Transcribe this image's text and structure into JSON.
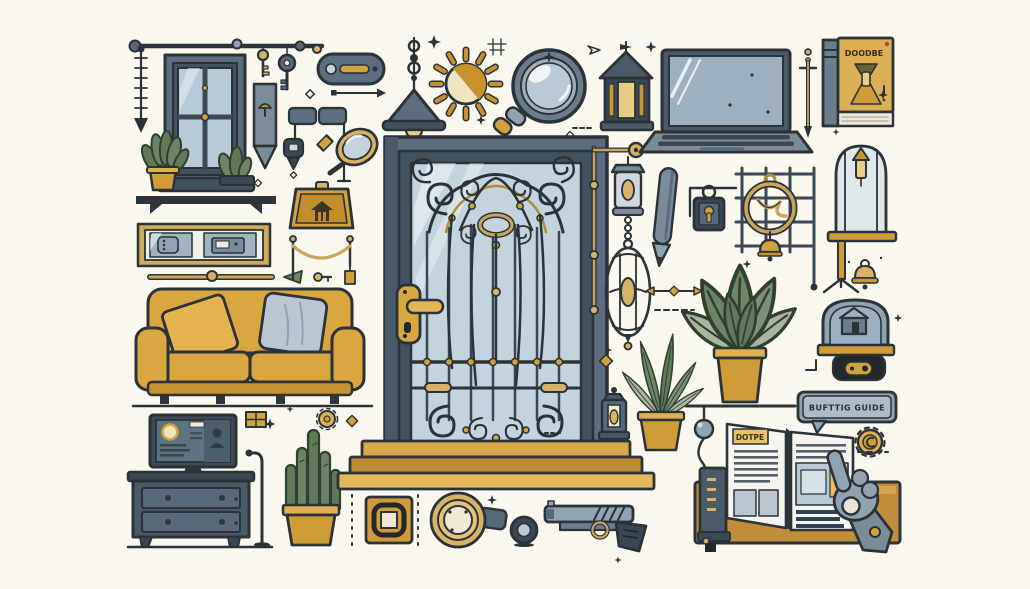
{
  "scene": {
    "description": "flat vector illustration collage of home, door-security and shopping-guide objects on cream background",
    "background": "#FAF8EE",
    "palette": {
      "outline": "#2B3238",
      "slate": "#5B6D7E",
      "slate_dark": "#42525F",
      "slate_light": "#B9CAD6",
      "gold": "#D2A23D",
      "gold_dark": "#A87C26",
      "gold_light": "#E9CD85",
      "green": "#5E7A58",
      "green_back": "#A9B49B",
      "wood": "#C18D3C",
      "paper": "#F5F4EE"
    },
    "texts": {
      "book_cover_title": "DOODBE",
      "guide_page_label": "DOTPE",
      "speech_bubble_label": "BUFTTIG GUIDE"
    },
    "objects": [
      "curtain-rod",
      "measuring-arrow",
      "window",
      "window-plants",
      "wall-shelf",
      "picture-frame",
      "sofa",
      "gold-rod",
      "green-leaf",
      "mini-keys",
      "tv",
      "dresser",
      "floor-lamp",
      "cactus",
      "grid-icon",
      "small-coin",
      "hanging-keys",
      "pennant",
      "key-fob-diagram",
      "hand-mirror",
      "house-plaque",
      "rope-swag",
      "pill-button",
      "arrow-marker",
      "pendant-lamp",
      "sun",
      "magnifying-glass",
      "crosshair-mark",
      "paper-dart",
      "ornate-door",
      "door-handle",
      "door-steps",
      "wall-bracket-lamp",
      "hanging-birdcage",
      "small-lantern",
      "roof-lantern",
      "laptop",
      "sword-pin",
      "hardcover-book",
      "pencil",
      "padlock",
      "gate-grille",
      "grille-emblem",
      "hanging-bell",
      "large-potted-plant",
      "small-potted-plant",
      "shelf-line",
      "cord-plug",
      "caged-stand",
      "bell-ornament",
      "dome-camera",
      "speech-bubble",
      "spiky-coin",
      "wooden-table",
      "standing-book-spine",
      "open-guide-booklet",
      "hand-cursor",
      "wall-plate",
      "door-knocker",
      "viewer-lens",
      "pistol",
      "sparkle-decorations",
      "diamond-accents",
      "dashed-lines"
    ]
  }
}
